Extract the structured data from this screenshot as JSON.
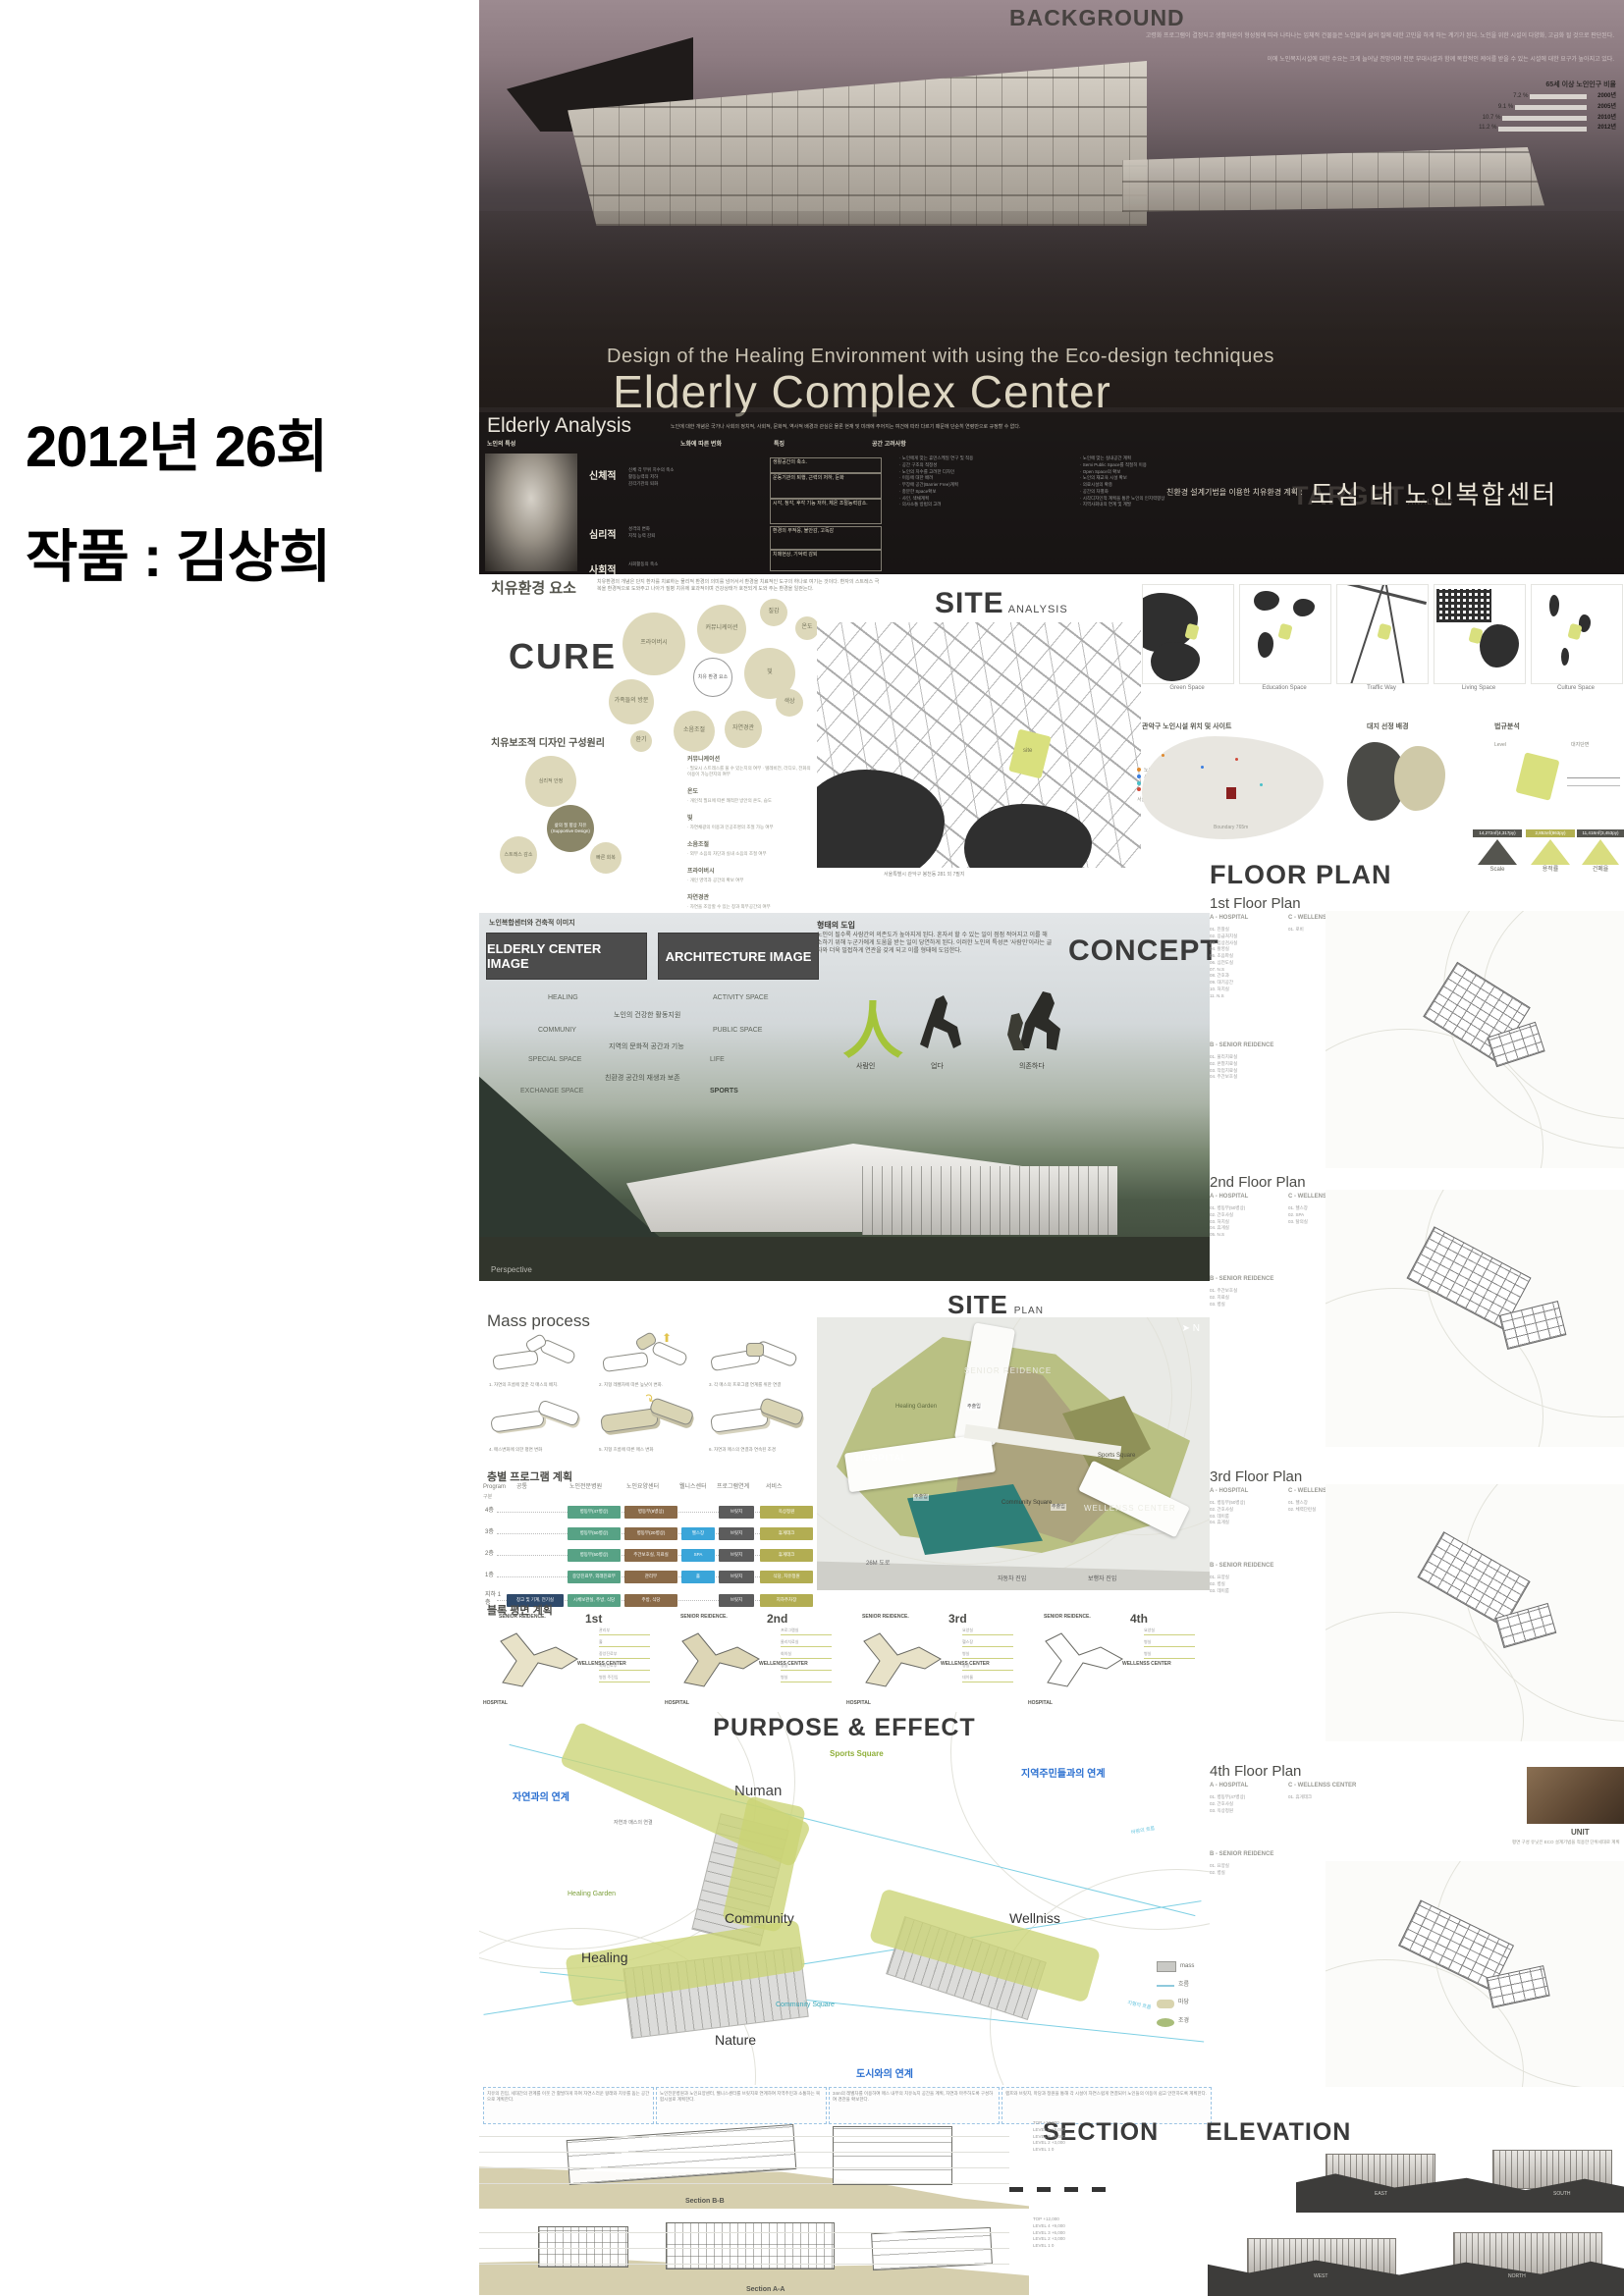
{
  "page": {
    "caption_line1": "2012년 26회",
    "caption_line2": "작품 : 김상희"
  },
  "hero": {
    "background_title": "BACKGROUND",
    "background_p1": "고령화 프로그램이 결정되고 생활자원이 형성됨에 따라 나타나는 입체적 건물들은 노인들의 삶의 질에 대한 고민을 하게 하는 계기가 된다. 노인을 위한 시설이 다양화, 고급화 될 것으로 판단된다.",
    "background_p2": "이에 노인복지시설에 대한 수요는 크게 늘어날 전망이며 전문 부대시설과 함께 복합적인 케어를 받을 수 있는 시설에 대한 요구가 높아지고 있다.",
    "subtitle_en": "Design of the Healing Environment with using the Eco-design techniques",
    "title_en": "Elderly Complex Center",
    "target_title": "TARGET",
    "target_sub": "ANALYSIS",
    "subtitle_kr_prefix": "친환경 설계기법을 이용한 치유환경 계획 :",
    "subtitle_kr_main": "도심 내 노인복합센터"
  },
  "chart_data": {
    "type": "bar",
    "orientation": "horizontal",
    "title": "65세 이상 노인인구 비율",
    "categories": [
      "2000년",
      "2005년",
      "2010년",
      "2012년"
    ],
    "values": [
      7.2,
      9.1,
      10.7,
      11.2
    ],
    "value_labels": [
      "7.2 %",
      "9.1 %",
      "10.7 %",
      "11.2 %"
    ],
    "unit": "%",
    "xlim": [
      0,
      12
    ],
    "grid": false,
    "legend": "none"
  },
  "elderly": {
    "title": "Elderly Analysis",
    "note": "노인에 대한 개념은 국가나 사회의 정치적, 사회적, 문화적, 역사적 배경과 관심은 물론 현재 및 미래에 주어지는 여건에 따라 다르기 때문에 단순히 연령만으로 규정할 수 없다.",
    "col1": "노인의 특성",
    "col2": "노화에 따른 변화",
    "col3": "특징",
    "col4": "공간 고려사항",
    "cat1": "신체적",
    "cat2": "심리적",
    "cat3": "사회적",
    "changes1": [
      "신체 각 부위 치수의 축소",
      "활동능력의 저하",
      "감각기관의 퇴화"
    ],
    "changes2": [
      "성격의 변화",
      "지적 능력 감퇴"
    ],
    "changes3": [
      "사회활동의 축소"
    ],
    "feat1a": "생활공간의 축소.",
    "feat1b": "운동기관의 퇴행, 근력의 저하, 둔화",
    "feat1c": "시각, 청각, 후각 기능 저하, 체온 조절능력감소.",
    "feat2a": "환경의 부적응, 불안감, 고독감",
    "feat2b": "치매현상, 기억력 감퇴",
    "cons_a": [
      "· 노인에게 맞는 휴먼스케일 연구 및 적용",
      "· 공간 구조의 적정성",
      "· 노인의 치수를 고려한 디자인",
      "· 이동에 대한 배려",
      "· 무장애 공간(Barrier Free)계획",
      "· 충분한 Space확보",
      "· 사인, 색채계획",
      "· 의사소통 방법의 고려"
    ],
    "cons_b": [
      "· 노인에 맞는 실내공간 계획",
      "· Semi Public Space를 적절히 이용",
      "· Open Space의 확보",
      "· 노인의 재교육 시설 확보",
      "· 의료시설의 확충",
      "· 공간의 차별화",
      "· 시각디자인적 계획을 통한 노인의 인지력향상",
      "· 지역사회내의 연계 및 계발"
    ]
  },
  "cure": {
    "header": "치유환경 요소",
    "desc": "치유환경의 개념은 단지 환자를 치료하는 물리적 환경의 의미를 넘어서서 환경을 치료적인 도구의 하나로 여기는 것이다. 환자의 스트레스 극복을 환경적으로 도와주고 나아가 질병 치유에 효과적이며 건강상태가 호전되게 도와 주는 환경을 일컫는다.",
    "big": "CURE",
    "bubbles": [
      "프라이버시",
      "커뮤니케이션",
      "질감",
      "온도",
      "가족들의 방문",
      "빛",
      "환기",
      "소음조절",
      "자연경관",
      "색상"
    ],
    "center": "치유 환경 요소",
    "principle_header": "치유보조적 디자인 구성원리",
    "diagram_center": "삶의 질 향상 치유 (Supportive Design)",
    "diagram_sat": [
      "심리적 안정",
      "스트레스 감소",
      "빠른 회복"
    ],
    "items": [
      {
        "term": "커뮤니케이션",
        "desc": "· 필요시 스트레스를 풀 수 있는지의 여부 · 텔레비전, 라디오, 전화의 이용이 가능한지의 여부"
      },
      {
        "term": "온도",
        "desc": "· 개인적 필요에 따른 쾌적한 방안의 온도, 습도"
      },
      {
        "term": "빛",
        "desc": "· 자연채광의 이용과 인공조명의 조절 가능 여부"
      },
      {
        "term": "소음조절",
        "desc": "· 외부 소음의 차단과 실내 소음의 조절 여부"
      },
      {
        "term": "프라이버시",
        "desc": "· 개인 영역과 공간의 확보 여부"
      },
      {
        "term": "자연경관",
        "desc": "· 자연을 조망할 수 있는 창과 외부공간의 여부"
      },
      {
        "term": "가족들의 방문",
        "desc": "· 가족과 함께 머물 수 있는 공간의 여부"
      }
    ]
  },
  "site_analysis": {
    "title": "SITE",
    "title_sub": "ANALYSIS",
    "site_label": "site",
    "map_caption": "서울특별시 관악구 봉천동 281 외 7필지",
    "legend": [
      "노인 교실, 노인 대학",
      "사회복지법인 노인시설",
      "재가노인 복지시설",
      "노인전문병원"
    ],
    "legend_note": "서울특별시의 노인시설과 노인인구 밀집 지역",
    "maps": [
      "Green Space",
      "Education Space",
      "Traffic Way",
      "Living Space",
      "Culture Space"
    ],
    "sub1": "관악구 노인시설 위치 및 사이트",
    "sub2": "대지 선정 배경",
    "sub3": "법규분석",
    "level_label": "Level",
    "section_label": "대지단면",
    "boundary": "Boundary 765m",
    "stats": [
      {
        "value": "14,272㎡(4,317py)",
        "label": "Scale"
      },
      {
        "value": "2,853㎡(863py)",
        "label": "용적률"
      },
      {
        "value": "11,418㎡(3,453py)",
        "label": "건폐율"
      }
    ]
  },
  "concept": {
    "header_small": "노인복합센터와 건축적 이미지",
    "box1": "ELDERLY CENTER IMAGE",
    "box2": "ARCHITECTURE IMAGE",
    "left_list": [
      "HEALING",
      "COMMUNIY",
      "SPECIAL SPACE",
      "EXCHANGE SPACE"
    ],
    "mid_list": [
      "노인의 건강한 활동지원",
      "지역의 문화적 공간과 기능",
      "친환경 공간의 재생과 보존"
    ],
    "right_list": [
      "ACTIVITY SPACE",
      "PUBLIC SPACE",
      "LIFE",
      "SPORTS"
    ],
    "form_title": "형태의 도입",
    "form_text": "노인이 될수록 사람간의 의존도가 높아지게 된다. 혼자서 할 수 있는 일이 점점 적어지고 이를 해소하기 위해 누군가에게 도움을 받는 일이 당연하게 된다. 이러한 노인의 특성은 '사람인'이라는 글자와 더욱 밀접하게 연관을 갖게 되고 이를 형태에 도입한다.",
    "glyph": "人",
    "fig1": "사람인",
    "fig2": "업다",
    "fig3": "의존하다",
    "title": "CONCEPT",
    "perspective": "Perspective"
  },
  "floor_plan": {
    "title": "FLOOR PLAN",
    "plans": [
      {
        "header": "1st Floor Plan",
        "subA": "A - HOSPITAL",
        "subC": "C - WELLENSS CENTER",
        "roomsA": [
          "01. 진찰실",
          "02. 응급처치실",
          "03. 임상검사실",
          "04. 촬영실",
          "05. 초음파실",
          "06. 심전도실",
          "07. N.S",
          "08. 간호과",
          "09. 대기공간",
          "10. 처치실",
          "11. N.S"
        ],
        "roomsC": [
          "01. 로비"
        ],
        "subB": "B - SENIOR REIDENCE",
        "roomsB": [
          "01. 물리치료실",
          "02. 온열치료실",
          "03. 작업치료실",
          "04. 주간보호실"
        ]
      },
      {
        "header": "2nd Floor Plan",
        "subA": "A - HOSPITAL",
        "subC": "C - WELLENSS CENTER",
        "roomsA": [
          "01. 병동부(50병상)",
          "02. 간호사실",
          "03. 처치실",
          "04. 휴게실",
          "05. N.S"
        ],
        "roomsC": [
          "01. 헬스장",
          "02. SPA",
          "03. 탈의실"
        ],
        "subB": "B - SENIOR REIDENCE",
        "roomsB": [
          "01. 주간보호실",
          "02. 치료실",
          "03. 병실"
        ]
      },
      {
        "header": "3rd Floor Plan",
        "subA": "A - HOSPITAL",
        "subC": "C - WELLENSS CENTER",
        "roomsA": [
          "01. 병동부(50병상)",
          "02. 간호사실",
          "03. 데이룸",
          "04. 휴게실"
        ],
        "roomsC": [
          "01. 헬스장",
          "02. 체력단련실"
        ],
        "subB": "B - SENIOR REIDENCE",
        "roomsB": [
          "01. 요양실",
          "02. 병실",
          "03. 데이룸"
        ]
      },
      {
        "header": "4th Floor Plan",
        "subA": "A - HOSPITAL",
        "subC": "C - WELLENSS CENTER",
        "roomsA": [
          "01. 병동부(47병상)",
          "02. 간호사실",
          "03. 옥상정원"
        ],
        "roomsC": [
          "01. 휴게데크"
        ],
        "subB": "B - SENIOR REIDENCE",
        "roomsB": [
          "01. 요양실",
          "02. 병실"
        ]
      }
    ],
    "unit_label": "UNIT",
    "unit_note": "평면 구성 유닛은 ECO 설계기법을 적용한 단위세대로 계획"
  },
  "site_plan": {
    "title": "SITE",
    "title_sub": "PLAN",
    "north": "N",
    "senior": "SENIOR REIDENCE",
    "healing_garden": "Healing Garden",
    "hospital": "HOSPITAL",
    "sports_square": "Sports Square",
    "community_square": "Community Square",
    "wellness": "WELLENSS CENTER",
    "entry1": "주출입",
    "entry2": "주출입",
    "entry3": "주출입",
    "road": "26M 도로",
    "car_entry": "자동차 진입",
    "ped_entry": "보행자 진입"
  },
  "mass_process": {
    "title": "Mass process",
    "steps": [
      "1. 자연의 흐름에 맞춘 각 매스의 배치.",
      "2. 지형 레벨차에 따른 높낮이 변화.",
      "3. 각 매스의 프로그램 연계를 위한 연결",
      "4. 매스변화에 의한 평면 변화",
      "5. 지형 흐름에 따른 매스 변화",
      "6. 자연과 매스의 연결과 연속된 조경"
    ]
  },
  "program_plan": {
    "title": "층별 프로그램 계획",
    "headers": [
      "Program",
      "공통",
      "노인전문병원",
      "노인요양센터",
      "웰니스센터",
      "프로그램연계",
      "서비스"
    ],
    "gubun": "구분",
    "rows": [
      {
        "floor": "4층",
        "c2": "병동부(47병상)",
        "c3": "병동부(8병상)",
        "c5": "브릿지",
        "c6": "옥상정원"
      },
      {
        "floor": "3층",
        "c2": "병동부(50병상)",
        "c3": "병동부(20병상)",
        "c4": "헬스장",
        "c5": "브릿지",
        "c6": "휴게데크"
      },
      {
        "floor": "2층",
        "c2": "병동부(50병상)",
        "c3": "주간보호실, 치료실",
        "c4": "SPA",
        "c5": "브릿지",
        "c6": "휴게데크"
      },
      {
        "floor": "1층",
        "c2": "중앙진료부, 외래진료부",
        "c3": "관리부",
        "c4": "홀",
        "c5": "브릿지",
        "c6": "식당, 치유정원"
      },
      {
        "floor": "지하 1층",
        "c1": "창고 및 기계, 전기실",
        "c2": "시체보관실, 주방, 식당",
        "c3": "주방, 식당",
        "c5": "브릿지",
        "c6": "지하주차장"
      }
    ]
  },
  "block_plan": {
    "title": "블록 평면 계획",
    "blocks": [
      {
        "ordinal": "1st",
        "senior": "SENIOR REIDENCE.",
        "wellness": "WELLENSS CENTER",
        "hospital": "HOSPITAL",
        "callouts": [
          "관리부",
          "홀",
          "중앙진료부",
          "외래진료부",
          "병원 주진입"
        ]
      },
      {
        "ordinal": "2nd",
        "senior": "SENIOR REIDENCE.",
        "wellness": "WELLENSS CENTER",
        "hospital": "HOSPITAL",
        "callouts": [
          "프로그램실",
          "물리치료실",
          "회의실",
          "병실",
          "병실"
        ]
      },
      {
        "ordinal": "3rd",
        "senior": "SENIOR REIDENCE.",
        "wellness": "WELLENSS CENTER",
        "hospital": "HOSPITAL",
        "callouts": [
          "요양실",
          "헬스장",
          "병실",
          "병실",
          "데이룸"
        ]
      },
      {
        "ordinal": "4th",
        "senior": "SENIOR REIDENCE.",
        "wellness": "WELLENSS CENTER",
        "hospital": "HOSPITAL",
        "callouts": [
          "요양실",
          "병실",
          "병실"
        ]
      }
    ]
  },
  "purpose": {
    "title": "PURPOSE & EFFECT",
    "sports_square": "Sports Square",
    "link_region": "지역주민들과의 연계",
    "link_nature": "자연과의 연계",
    "nature_mass": "자연과 매스의 연결",
    "numan": "Numan",
    "wind": "바람의 흐름",
    "healing_garden": "Healing Garden",
    "community": "Community",
    "wellniss": "Wellniss",
    "healing": "Healing",
    "community_square": "Community Square",
    "nature": "Nature",
    "terrain": "지형의 흐름",
    "link_city": "도시와의 연계",
    "legend": [
      "mass",
      "흐름",
      "마당",
      "조경"
    ],
    "notes": [
      "치유의 진입, 세대간의 관계를 이웃 간 활발하게 하여 자연스러운 왕래와 치유를 돕는 공간으로 계획한다.",
      "노인전문병원과 노인요양센터, 웰니스센터를 브릿지로 연계하여 지역주민과 소통하는 복합시설로 계획한다.",
      "34m의 레벨차를 이용하여 매스 내부의 치유녹지 공간을 계획, 자연과 마주하도록 구성하여 경관을 확보한다.",
      "램프와 브릿지, 마당과 정원을 통해 각 시설이 자연스럽게 연결되어 노인들의 이동이 쉽고 안전하도록 계획한다."
    ]
  },
  "section": {
    "title": "SECTION",
    "elevation_title": "ELEVATION",
    "b_label": "Section B-B",
    "a_label": "Section A-A",
    "levels": [
      "TOP  +12,000",
      "LEVEL 4  +9,000",
      "LEVEL 3  +6,000",
      "LEVEL 2  +3,000",
      "LEVEL 1  0"
    ],
    "elev_east": "EAST",
    "elev_south": "SOUTH",
    "elev_west": "WEST",
    "elev_north": "NORTH"
  }
}
